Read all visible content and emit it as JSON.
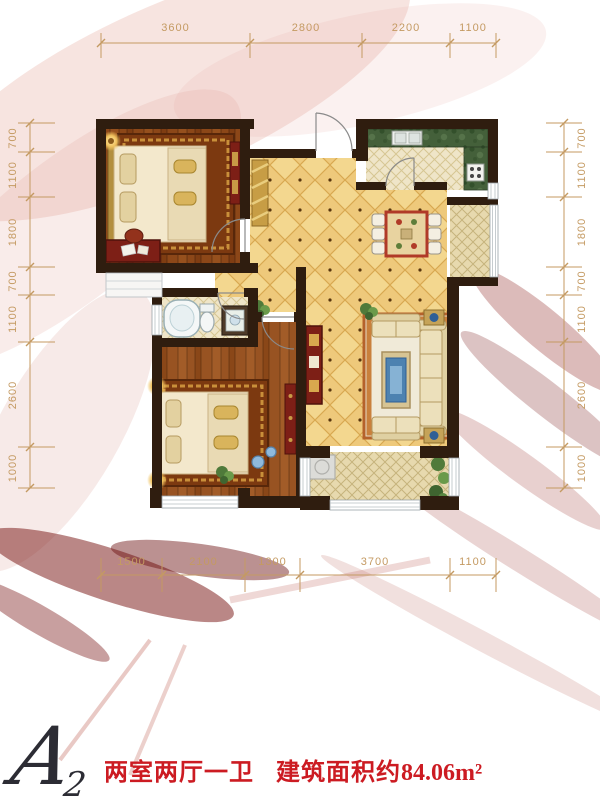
{
  "floorplan": {
    "unit_letter": "A",
    "unit_number": "2",
    "layout_text": "两室两厅一卫",
    "area_prefix": "建筑面积约",
    "area_value": "84.06",
    "area_unit": "m²",
    "dimensions": {
      "top": [
        "3600",
        "2800",
        "2200",
        "1100"
      ],
      "bottom": [
        "1500",
        "2100",
        "1300",
        "3700",
        "1100"
      ],
      "left": [
        "700",
        "1100",
        "1800",
        "700",
        "1100",
        "2600",
        "1000"
      ],
      "right": [
        "700",
        "1100",
        "1800",
        "700",
        "1100",
        "2600",
        "1000"
      ]
    },
    "colors": {
      "accent_red": "#cc1b22",
      "logo_dark": "#2c2c34",
      "dim_line": "#c49a62",
      "wall": "#2f1d0f",
      "tile_yellow": "#eec97b",
      "wood_floor": "#8c4718",
      "counter_green": "#44603a",
      "balcony_tile": "#e7d9ae"
    }
  }
}
